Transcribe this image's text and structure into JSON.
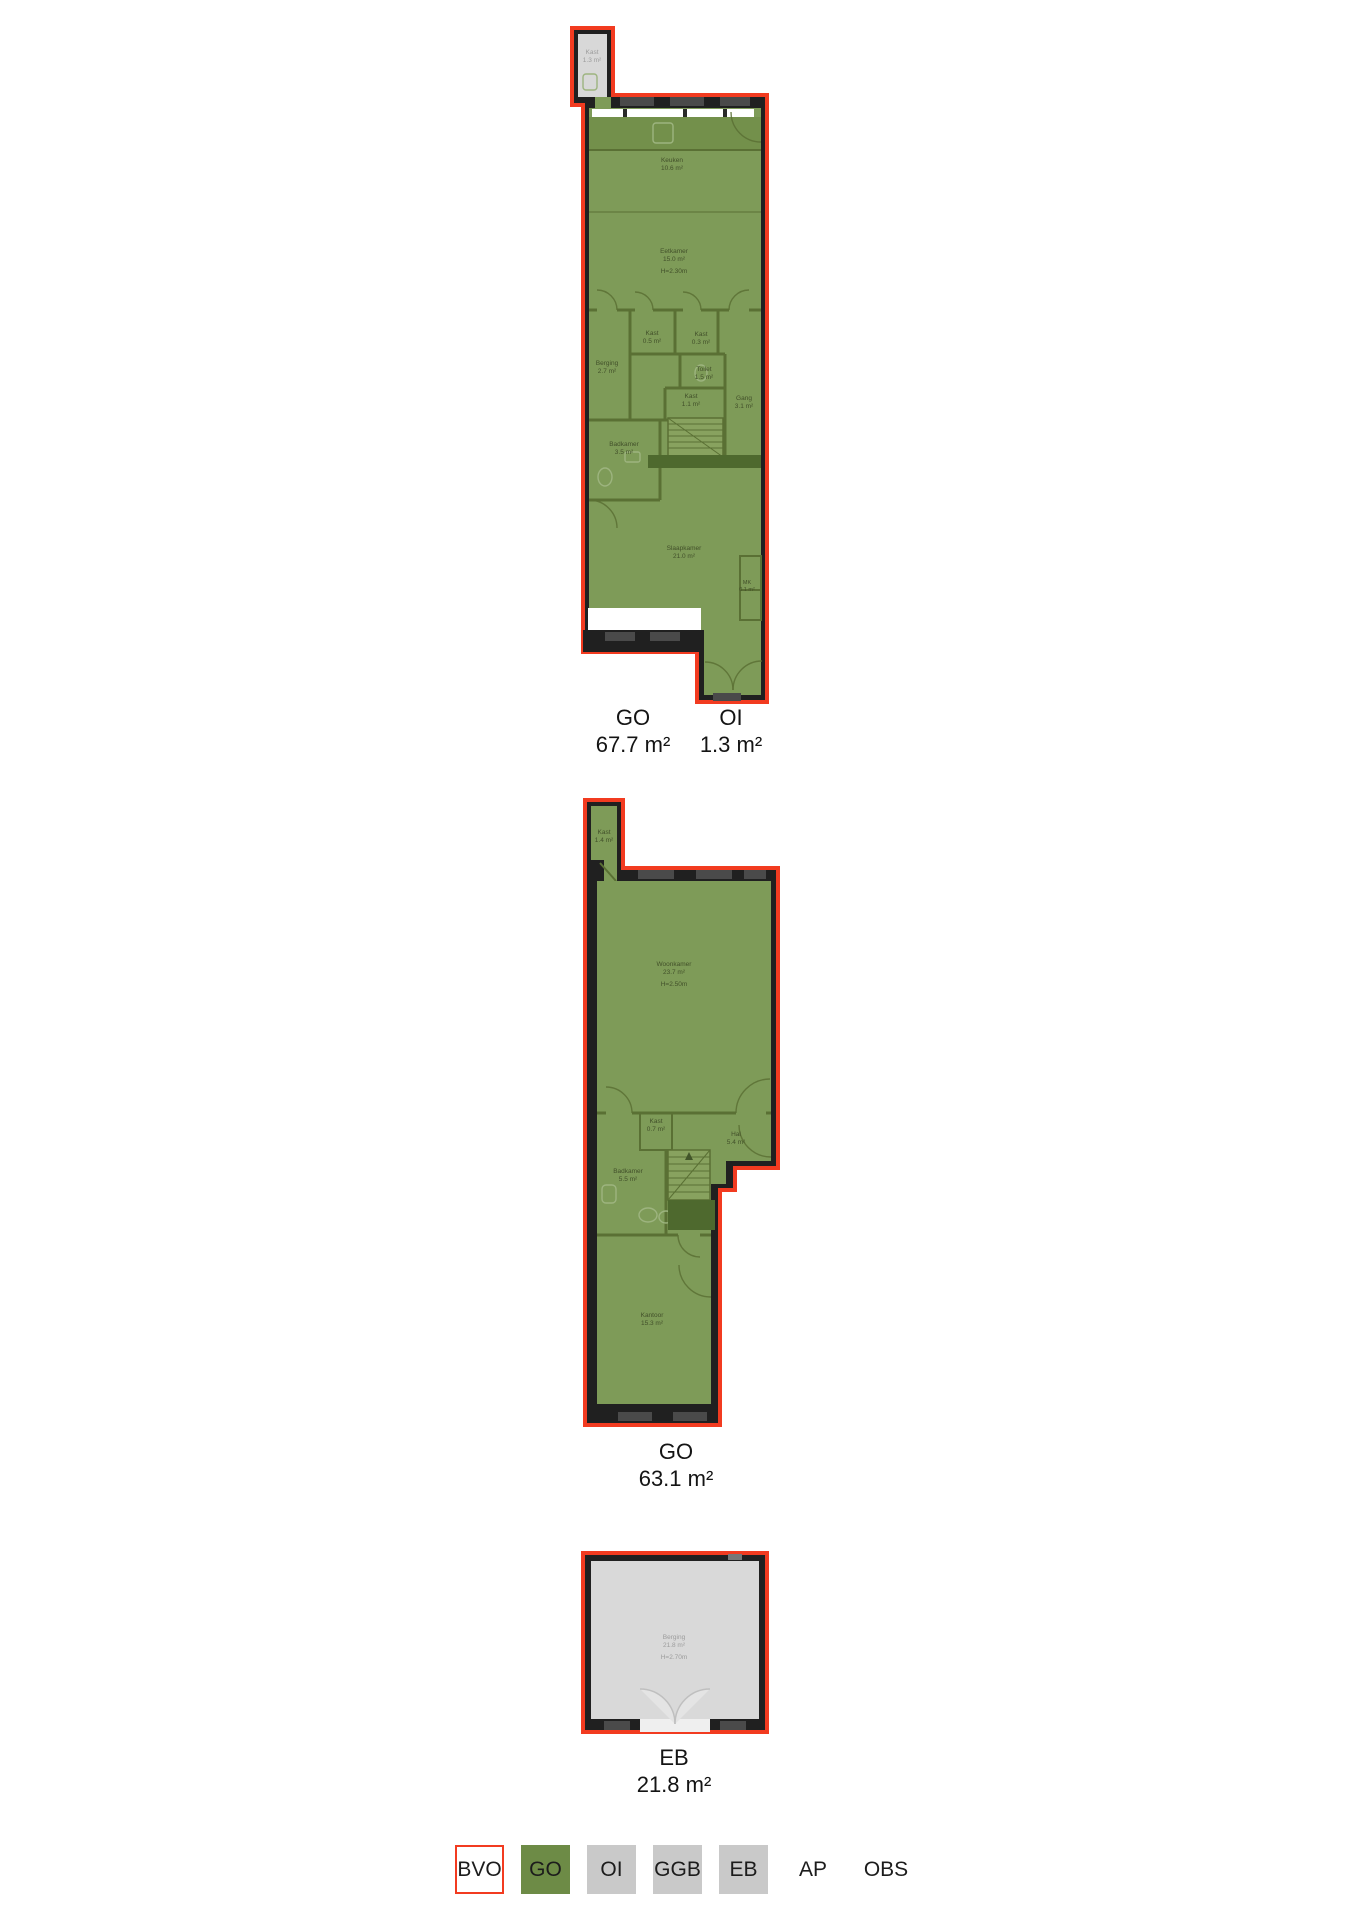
{
  "colors": {
    "bvo_outline": "#f23b20",
    "go_fill": "#7e9b58",
    "grey_fill": "#d9d9d9",
    "wall": "#202020",
    "inner_wall": "#5a7034",
    "stair_landing": "#4e692e",
    "legend_go": "#6d8b46",
    "legend_grey": "#c9c9c9",
    "counter": "#73904b"
  },
  "floors": [
    {
      "name": "first-floor",
      "rooms": [
        {
          "label": "Kast",
          "area": "1.3 m²"
        },
        {
          "label": "Keuken",
          "area": "10.6 m²"
        },
        {
          "label": "Eetkamer",
          "area": "15.0 m²",
          "height": "H=2.30m"
        },
        {
          "label": "Kast",
          "area": "0.5 m²"
        },
        {
          "label": "Kast",
          "area": "0.3 m²"
        },
        {
          "label": "Berging",
          "area": "2.7 m²"
        },
        {
          "label": "Toilet",
          "area": "1.5 m²"
        },
        {
          "label": "Kast",
          "area": "1.1 m²"
        },
        {
          "label": "Gang",
          "area": "3.1 m²"
        },
        {
          "label": "Badkamer",
          "area": "3.5 m²"
        },
        {
          "label": "Slaapkamer",
          "area": "21.0 m²"
        },
        {
          "label": "MK",
          "area": "0.1 m²"
        }
      ],
      "measurements": [
        {
          "code": "GO",
          "value": "67.7 m²"
        },
        {
          "code": "OI",
          "value": "1.3 m²"
        }
      ]
    },
    {
      "name": "second-floor",
      "rooms": [
        {
          "label": "Kast",
          "area": "1.4 m²"
        },
        {
          "label": "Woonkamer",
          "area": "23.7 m²",
          "height": "H=2.50m"
        },
        {
          "label": "Kast",
          "area": "0.7 m²"
        },
        {
          "label": "Hal",
          "area": "5.4 m²"
        },
        {
          "label": "Badkamer",
          "area": "5.5 m²"
        },
        {
          "label": "Kantoor",
          "area": "15.3 m²"
        }
      ],
      "measurements": [
        {
          "code": "GO",
          "value": "63.1 m²"
        }
      ]
    },
    {
      "name": "external-storage",
      "rooms": [
        {
          "label": "Berging",
          "area": "21.8 m²",
          "height": "H=2.70m"
        }
      ],
      "measurements": [
        {
          "code": "EB",
          "value": "21.8 m²"
        }
      ]
    }
  ],
  "legend": {
    "items": [
      {
        "code": "BVO",
        "style": "outline"
      },
      {
        "code": "GO",
        "style": "green"
      },
      {
        "code": "OI",
        "style": "grey"
      },
      {
        "code": "GGB",
        "style": "grey"
      },
      {
        "code": "EB",
        "style": "grey"
      },
      {
        "code": "AP",
        "style": "plain"
      },
      {
        "code": "OBS",
        "style": "plain"
      }
    ]
  }
}
